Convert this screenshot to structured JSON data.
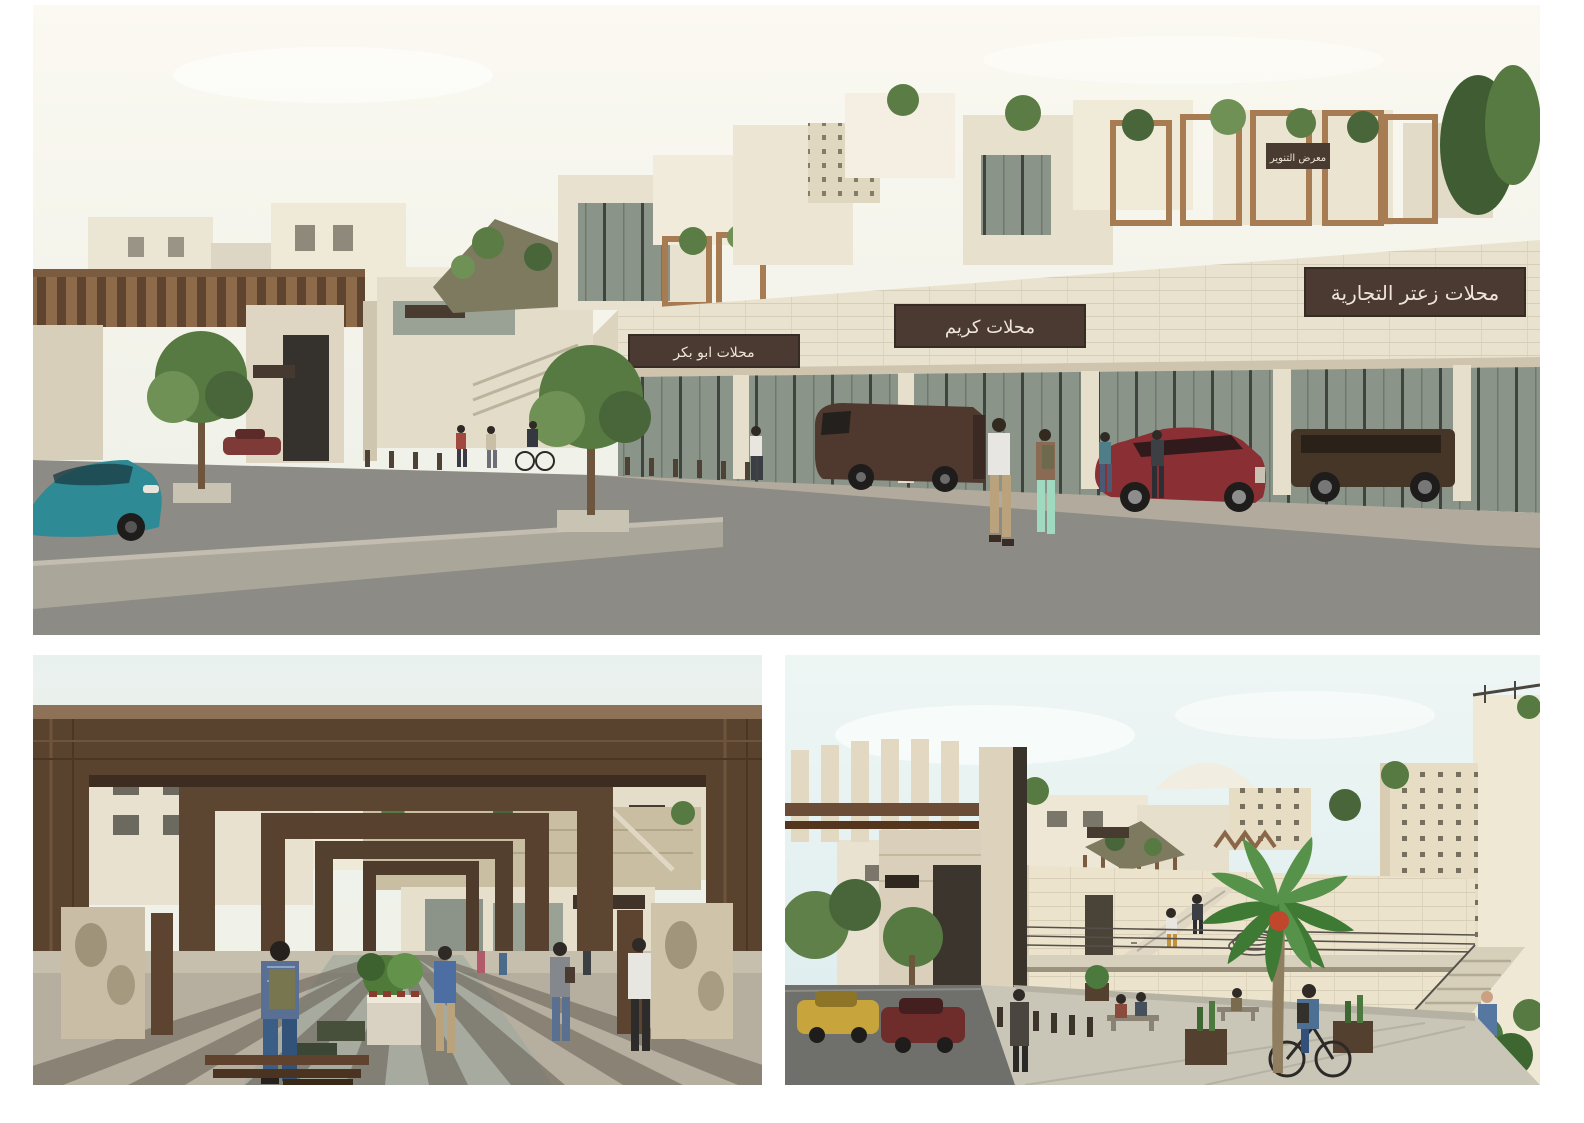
{
  "page": {
    "background_color": "#ffffff"
  },
  "collage": {
    "panels": [
      {
        "id": "street-elevation-render",
        "signs": {
          "upper_gallery": "معرض التنوير",
          "shop_left": "محلات ابو بكر",
          "shop_center": "محلات كريم",
          "shop_right": "محلات زعتر التجارية"
        },
        "palette": {
          "sky": "#faf8ef",
          "stone_wall": "#e9e2cf",
          "sign_background": "#4a3a32",
          "sign_text": "#eee6d8",
          "storefront_glass": "#8b9488",
          "asphalt": "#8d8b85",
          "sidewalk": "#b2ab9d",
          "pergola_wood": "#a87c52"
        },
        "vehicles": [
          {
            "name": "teal-sedan",
            "color": "#2e8a94"
          },
          {
            "name": "brown-van",
            "color": "#4f382e"
          },
          {
            "name": "maroon-suv",
            "color": "#8a2f33"
          },
          {
            "name": "brown-g-wagon",
            "color": "#453628"
          },
          {
            "name": "distant-red-car",
            "color": "#7e3a36"
          }
        ]
      },
      {
        "id": "pergola-walkway-render",
        "palette": {
          "sky": "#e9f1ee",
          "portal_wood": "#5a432e",
          "floor": "#b6ae9f",
          "shadow": "#5f584c",
          "planter_stone": "#d9d2c2",
          "bench_wood": "#5f432e"
        }
      },
      {
        "id": "sunken-plaza-render",
        "palette": {
          "sky": "#e3f0f1",
          "stone_wall": "#ece3cd",
          "plaza_floor": "#c9c5b7",
          "street": "#6f706c",
          "taxi_yellow": "#c8a43c",
          "dark_red_car": "#6e2d2b",
          "palm_green": "#3e7a33",
          "accent_plants_orange": "#b85730"
        }
      }
    ]
  }
}
